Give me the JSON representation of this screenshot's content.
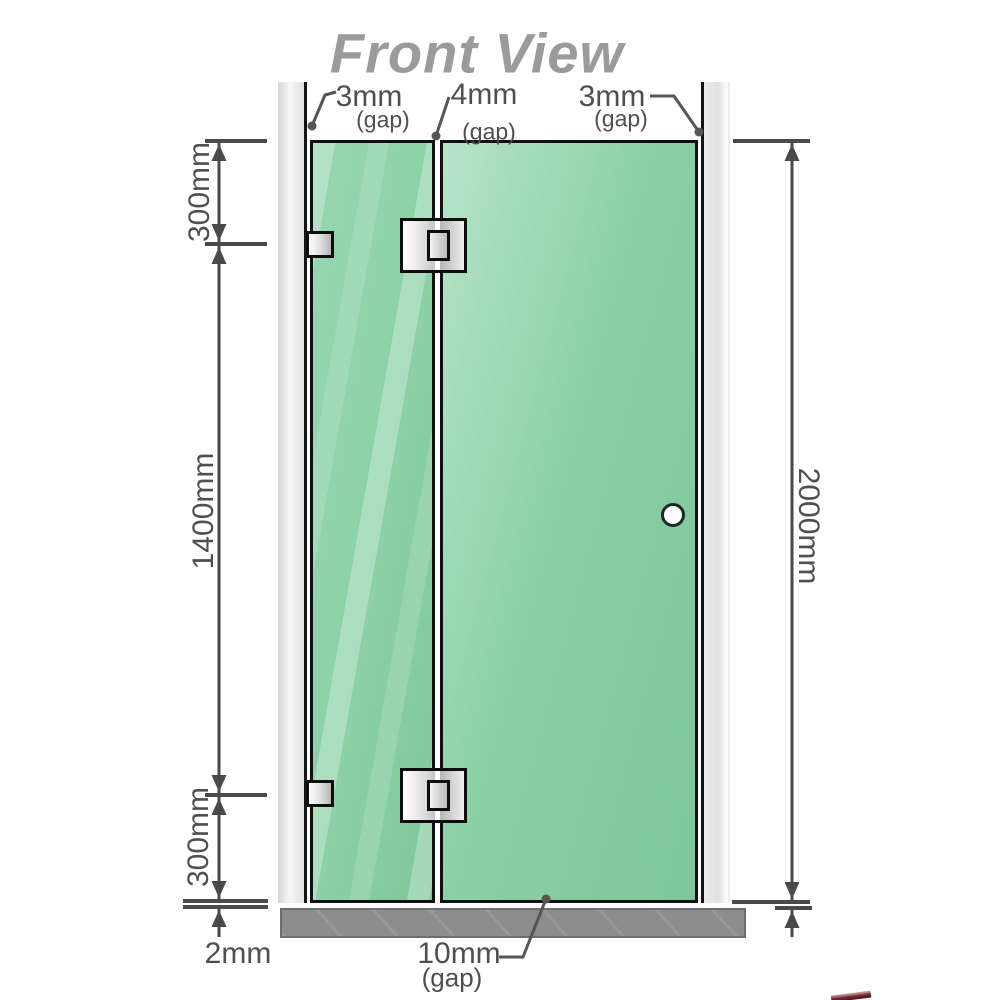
{
  "title": "Front View",
  "diagram": {
    "gaps": {
      "left": {
        "value": "3mm",
        "label": "(gap)"
      },
      "middle": {
        "value": "4mm",
        "label": "(gap)"
      },
      "right": {
        "value": "3mm",
        "label": "(gap)"
      },
      "bottom": {
        "value": "10mm",
        "label": "(gap)"
      },
      "floor": {
        "value": "2mm"
      }
    },
    "dimensions": {
      "top_left": "300mm",
      "middle_left": "1400mm",
      "bottom_left": "300mm",
      "right_total": "2000mm"
    },
    "colors": {
      "glass": "#8bd0a6",
      "wall": "#e9e9e9",
      "floor": "#8d8d8d",
      "line": "#4a4a4a",
      "title": "#9b9b9b",
      "ribbon": "#6d2730"
    }
  }
}
